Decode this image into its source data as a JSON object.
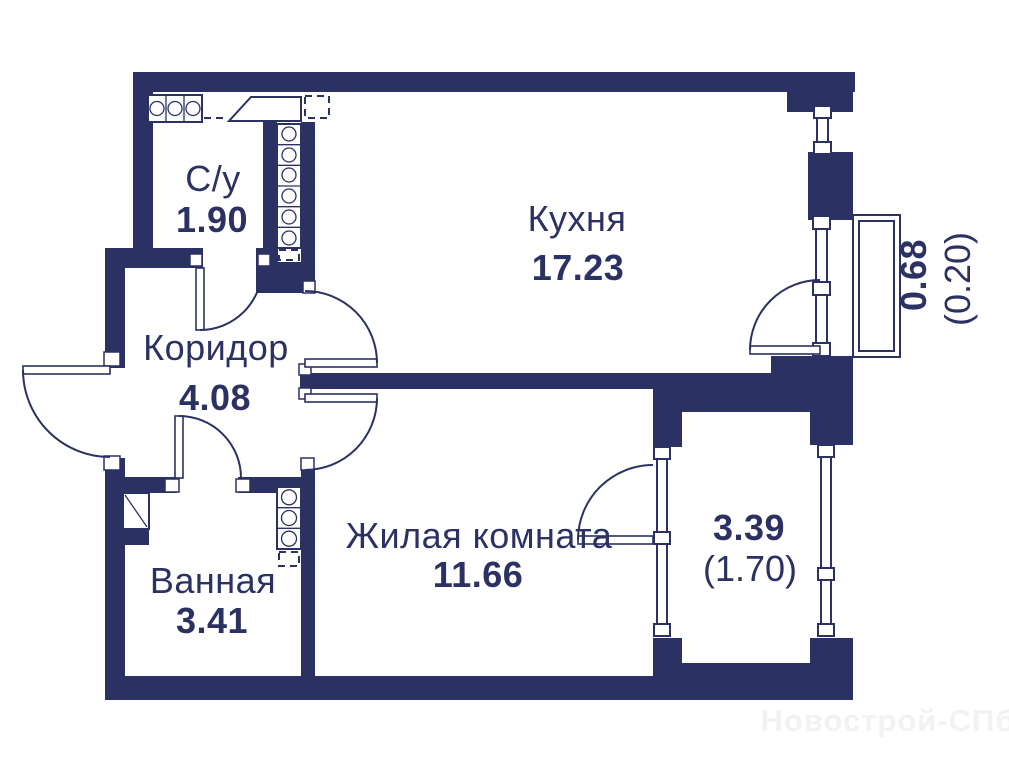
{
  "colors": {
    "wall": "#2b3163",
    "background": "#ffffff",
    "watermark": "#f2f2f2"
  },
  "rooms": {
    "wc": {
      "name": "С/у",
      "area": "1.90"
    },
    "kitchen": {
      "name": "Кухня",
      "area": "17.23"
    },
    "corridor": {
      "name": "Коридор",
      "area": "4.08"
    },
    "bathroom": {
      "name": "Ванная",
      "area": "3.41"
    },
    "living_room": {
      "name": "Жилая комната",
      "area": "11.66"
    },
    "loggia": {
      "area": "3.39",
      "area_secondary": "(1.70)"
    },
    "balcony": {
      "area": "0.68",
      "area_secondary": "(0.20)"
    }
  },
  "watermark": "Новострой-СПб"
}
